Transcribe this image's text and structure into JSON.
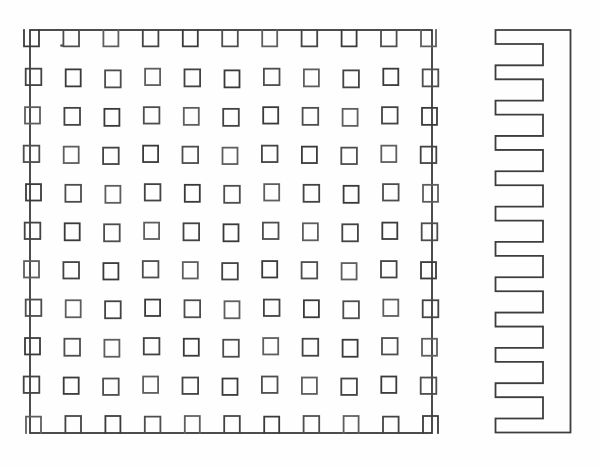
{
  "canvas": {
    "width": 600,
    "height": 466,
    "background": "#fefefe"
  },
  "drawing": {
    "plan_view": {
      "outer": {
        "x": 30,
        "y": 30,
        "width": 402,
        "height": 403
      },
      "outer_stroke": "#2e2e2e",
      "outer_stroke_width": 1.7,
      "grid": {
        "rows": 11,
        "cols": 11,
        "pin_width": 15,
        "pin_height": 17,
        "first_col_center": 32.5,
        "last_col_center": 429.5,
        "first_row_center": 39.4,
        "last_row_center": 424.2,
        "top_row_open_top": true,
        "bottom_row_open_bottom": true
      },
      "pin_stroke_width": 1.8,
      "stroke_palette": [
        "#3a3a3a",
        "#4d4d4d",
        "#5e5e5e",
        "#434343"
      ]
    },
    "side_view": {
      "tip_x": 495.5,
      "inner_x": 543,
      "right_x": 570.5,
      "top_y": 30,
      "bottom_y": 432.5,
      "teeth": 12,
      "tooth_height": 14,
      "stroke": "#3d3d3d",
      "stroke_width": 1.8
    },
    "speck": {
      "x": 61.5,
      "y": 45.5,
      "r": 1.3,
      "color": "#4f4f4f"
    }
  }
}
